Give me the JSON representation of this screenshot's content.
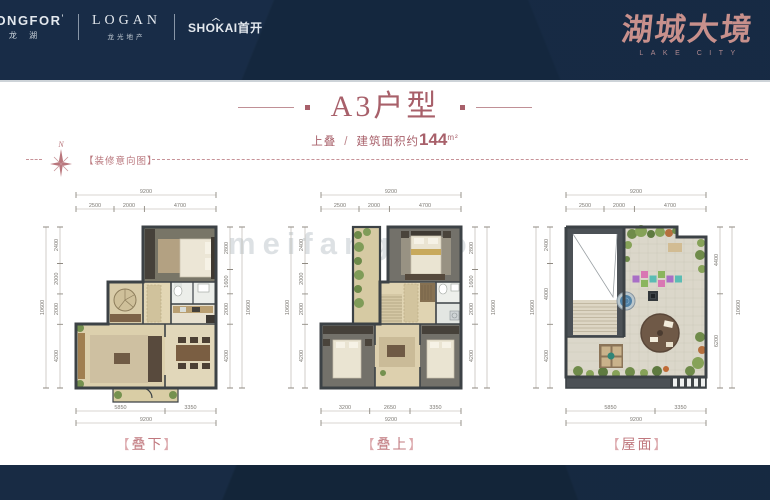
{
  "header": {
    "logos": {
      "longfor": {
        "name": "LONGFOR",
        "mark": "’",
        "sub": "龙 湖"
      },
      "logan": {
        "name": "LOGAN",
        "sub": "龙光地产"
      },
      "shokai": {
        "name": "SHOKAI",
        "suffix": "首开",
        "roof": "︿"
      }
    },
    "brand": {
      "name": "湖城大境",
      "tagline": "LAKE CITY"
    }
  },
  "title": {
    "text": "A3户型"
  },
  "subtitle": {
    "type": "上叠",
    "separator": "/",
    "area_label": "建筑面积约",
    "area_value": "144",
    "area_unit": "m²"
  },
  "annotation": {
    "compass": "N",
    "note": "【装修意向图】"
  },
  "watermark": "meifangguo",
  "labels": {
    "bracket_left": "【",
    "bracket_right": "】"
  },
  "plans": [
    {
      "caption": "叠下",
      "top_total": "9200",
      "top_segments": [
        "2500",
        "2000",
        "4700"
      ],
      "left_total": "10600",
      "left_segments": [
        "2400",
        "2000",
        "2000",
        "4200"
      ],
      "right_total": "10600",
      "right_segments": [
        "2800",
        "1600",
        "2000",
        "4200"
      ],
      "bottom_segments": [
        "5850",
        "3350"
      ],
      "bottom_total": "9200"
    },
    {
      "caption": "叠上",
      "top_total": "9200",
      "top_segments": [
        "2500",
        "2000",
        "4700"
      ],
      "left_total": "10600",
      "left_segments": [
        "2400",
        "2000",
        "2000",
        "4200"
      ],
      "right_total": "10600",
      "right_segments": [
        "2800",
        "1600",
        "2000",
        "4200"
      ],
      "bottom_segments": [
        "3200",
        "2650",
        "3350"
      ],
      "bottom_total": "9200"
    },
    {
      "caption": "屋面",
      "top_total": "9200",
      "top_segments": [
        "2500",
        "2000",
        "4700"
      ],
      "left_total": "10600",
      "left_segments": [
        "2400",
        "4000",
        "4200"
      ],
      "right_total": "10600",
      "right_segments": [
        "4400",
        "6200"
      ],
      "bottom_segments": [
        "5850",
        "3350"
      ],
      "bottom_total": "9200"
    }
  ]
}
